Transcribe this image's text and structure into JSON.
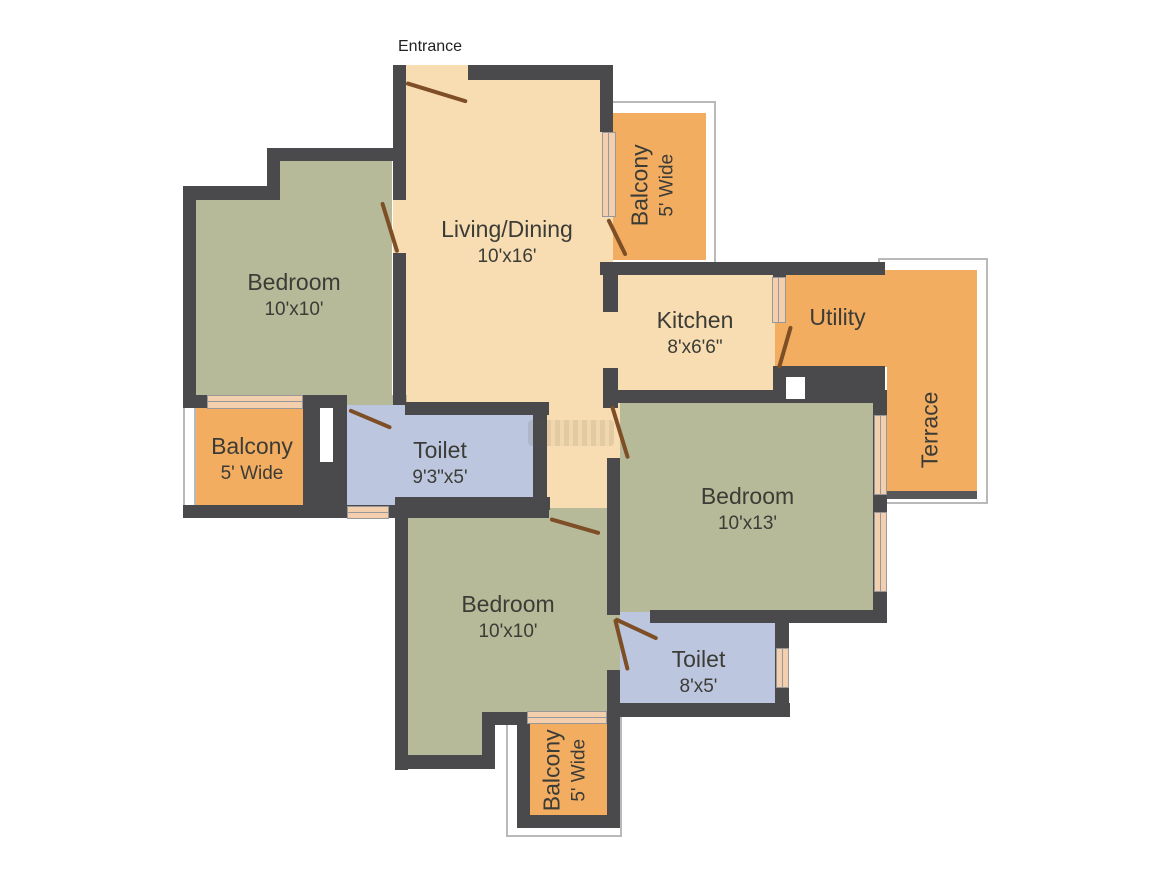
{
  "plan": {
    "entrance_label": "Entrance",
    "rooms": {
      "living": {
        "name": "Living/Dining",
        "dims": "10'x16'"
      },
      "balcony_top": {
        "name": "Balcony",
        "width_label": "5' Wide"
      },
      "bedroom_left": {
        "name": "Bedroom",
        "dims": "10'x10'"
      },
      "kitchen": {
        "name": "Kitchen",
        "dims": "8'x6'6\""
      },
      "utility": {
        "name": "Utility"
      },
      "terrace": {
        "name": "Terrace"
      },
      "balcony_left": {
        "name": "Balcony",
        "width_label": "5' Wide"
      },
      "toilet_left": {
        "name": "Toilet",
        "dims": "9'3\"x5'"
      },
      "bedroom_right": {
        "name": "Bedroom",
        "dims": "10'x13'"
      },
      "bedroom_bottom": {
        "name": "Bedroom",
        "dims": "10'x10'"
      },
      "toilet_bottom": {
        "name": "Toilet",
        "dims": "8'x5'"
      },
      "balcony_bottom": {
        "name": "Balcony",
        "width_label": "5' Wide"
      }
    },
    "colors": {
      "wall": "#4a4a4d",
      "floor_living": "#f7ddb1",
      "floor_bedroom": "#b7ba98",
      "floor_balcony": "#f2ad61",
      "floor_toilet": "#bcc6de",
      "door": "#7e4e26",
      "window_fill": "#f4cfae",
      "window_frame": "#98989a",
      "railing": "#b9b9b9",
      "text": "#3c3c37"
    }
  }
}
